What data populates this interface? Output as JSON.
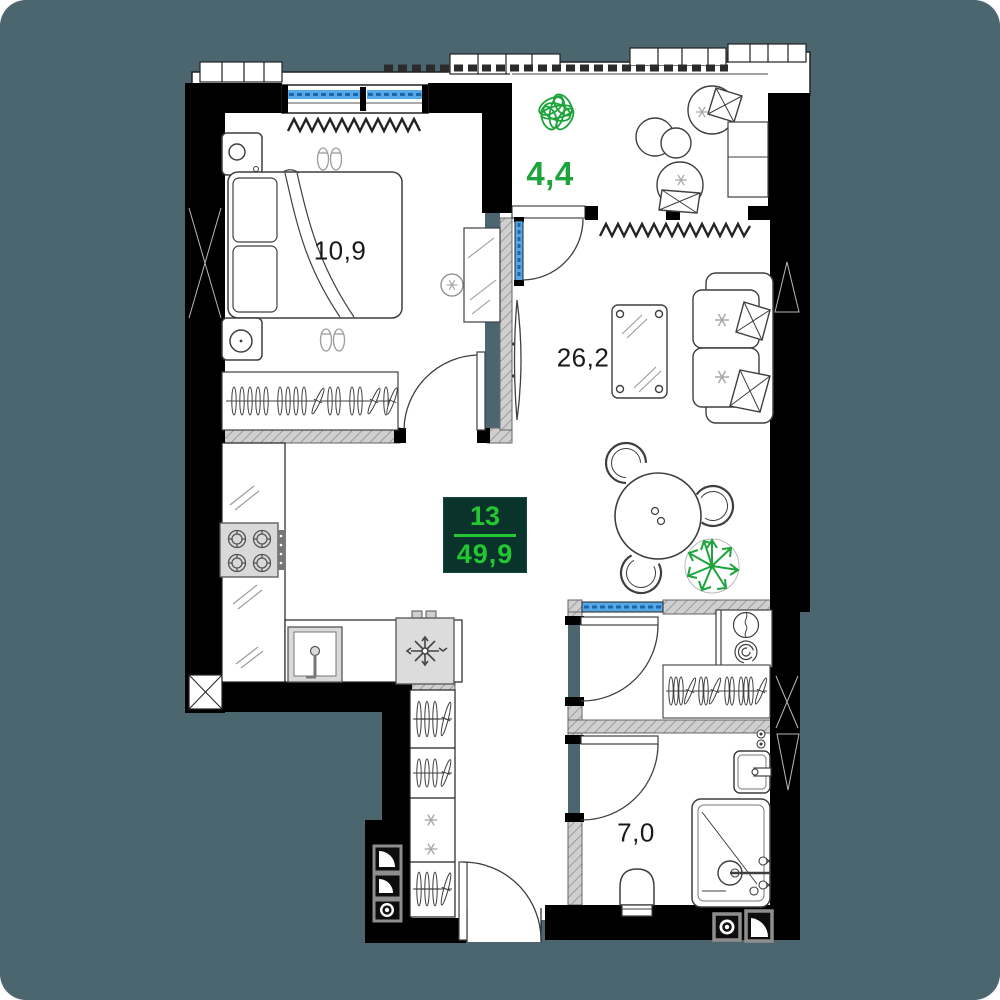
{
  "unit": {
    "number": "13",
    "total_area": "49,9"
  },
  "rooms": {
    "bedroom": {
      "name": "bedroom",
      "area": "10,9"
    },
    "balcony": {
      "name": "balcony",
      "area": "4,4"
    },
    "living": {
      "name": "living-kitchen",
      "area": "26,2"
    },
    "bathroom": {
      "name": "bathroom",
      "area": "7,0"
    }
  },
  "colors": {
    "background": "#4c6670",
    "wall": "#000000",
    "floor": "#ffffff",
    "partition_fill": "#cfcfcf",
    "window_blue": "#55a9e8",
    "window_dash_blue": "#1f66a8",
    "accent_green": "#1ea43c",
    "badge_background": "#0a332c",
    "badge_green": "#23c72f"
  },
  "icons": {
    "bedroom": [
      "double-bed",
      "pillow",
      "blanket",
      "nightstand-lamp",
      "nightstand",
      "slippers",
      "radiator",
      "wardrobe-rail",
      "mirror",
      "ceiling-light",
      "interior-door"
    ],
    "balcony": [
      "plant-bush",
      "lounge-chair",
      "cushion",
      "side-table",
      "bench",
      "balcony-door"
    ],
    "living": [
      "tv",
      "coffee-table",
      "sofa",
      "cushion",
      "dining-table",
      "dining-chair",
      "plant-fern",
      "radiator"
    ],
    "kitchen": [
      "counter",
      "stove",
      "kitchen-sink",
      "fridge-snowflake"
    ],
    "hall": [
      "hall-wardrobe",
      "clothes-hangers",
      "entrance-door",
      "vent-fan",
      "vent-duct",
      "ceiling-light"
    ],
    "closet": [
      "washing-machine",
      "tumble-dryer",
      "clothes-rail",
      "interior-window"
    ],
    "bathroom": [
      "toilet",
      "wash-basin",
      "shower",
      "shower-mixer",
      "shutoff-valves",
      "vent-fan",
      "vent-duct"
    ]
  }
}
